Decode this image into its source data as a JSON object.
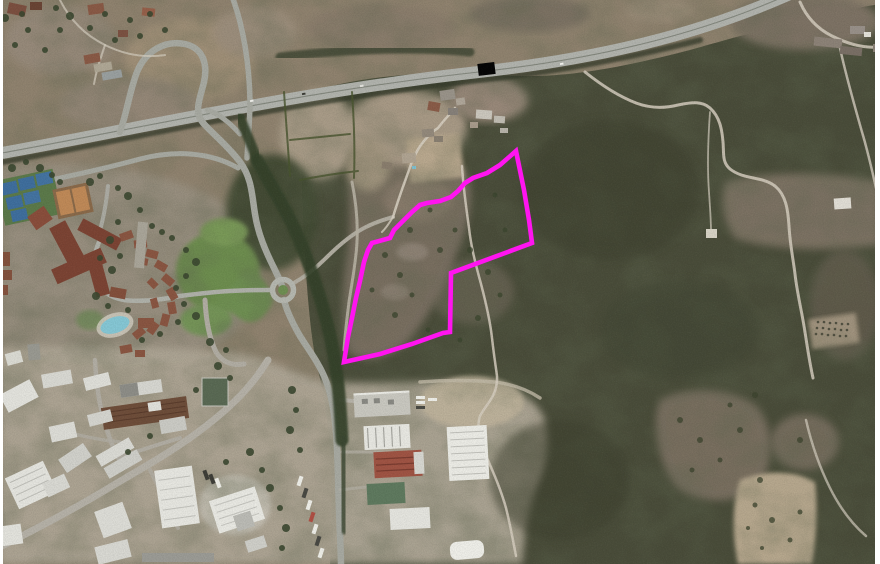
{
  "map": {
    "kind": "aerial-orthophoto",
    "features": {
      "highway": "motorway with loop interchange crossing upper part of image",
      "overpass_marker": "small black rectangle on motorway",
      "roundabout": "roundabout with green island, centre-left",
      "resort_complex": "hotel with terracotta roofs, villa arc, tennis courts, clay courts, swimming pool, lawns",
      "industrial_estate": "white warehouse buildings lower-left and bottom-centre",
      "stream_treeline": "dark riparian tree corridor running north-south in centre",
      "scrubland": "dark green maquis covering right half",
      "dirt_tracks": "winding unpaved tracks across the hillside",
      "farm_fields": "tan ploughed fields near centre and bottom-right"
    },
    "colors": {
      "scrub_dark": "#4a4d3a",
      "parcel_scrub": "#7b7163",
      "field_tan": "#b3a48e",
      "lawn_green": "#6e8e50",
      "road_gray": "#a8aaa2",
      "dirt_track": "#d6cec0",
      "roof_terracotta": "#8a5642",
      "tennis_blue": "#3f6f9e",
      "clay_court": "#c08a58",
      "pool_cyan": "#86c8d6",
      "warehouse_white": "#e6e6e0",
      "tilled_field_brown": "#6b4a36"
    }
  },
  "overlay": {
    "parcel_polygon": {
      "color": "#ff14f0",
      "stroke_width": 4.6,
      "points": "516,151 500,165 487,173 473,178 465,183 458,191 451,197 440,201 427,203 420,205 412,212 402,222 394,230 390,238 372,243 368,250 364,262 360,281 356,298 352,318 348,337 344,362 380,354 412,344 443,333 450,332 451,273 532,243 529,220 524,190"
    }
  }
}
